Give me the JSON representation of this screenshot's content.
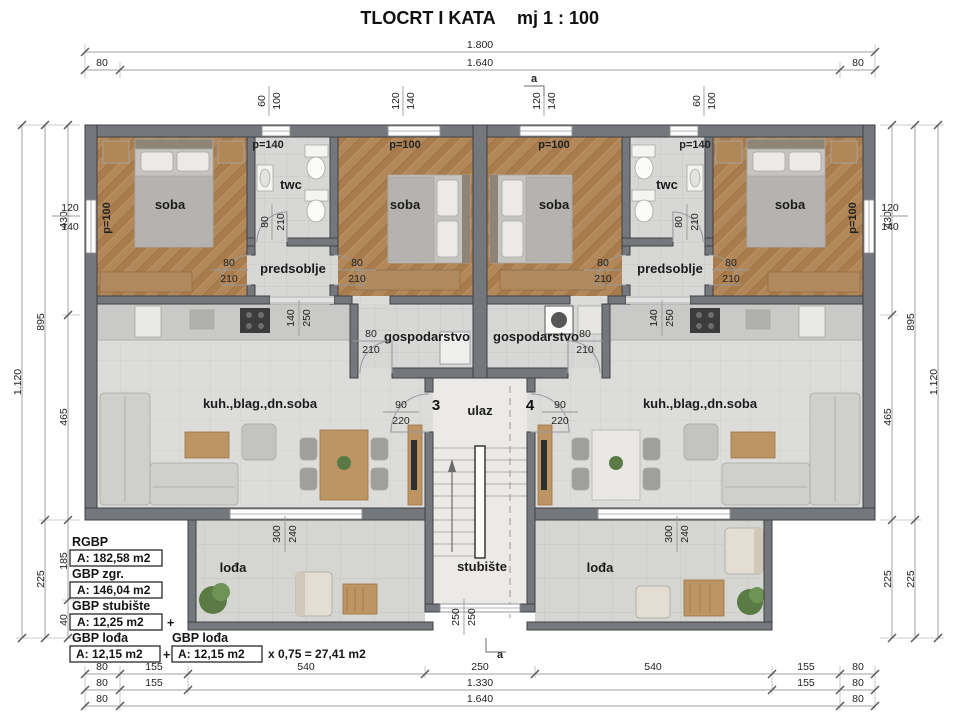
{
  "title": {
    "main": "TLOCRT I KATA",
    "scale": "mj 1 : 100"
  },
  "section_marker": "a",
  "dims": {
    "top": {
      "total": "1.800",
      "parts": [
        "80",
        "1.640",
        "80"
      ],
      "openings": [
        [
          "60",
          "100"
        ],
        [
          "120",
          "140"
        ],
        [
          "120",
          "140"
        ],
        [
          "60",
          "100"
        ]
      ]
    },
    "left": {
      "total": "1.120",
      "mid": [
        "895",
        "225"
      ],
      "inner": [
        "430",
        "465",
        "185",
        "40"
      ],
      "window": [
        "120",
        "140"
      ]
    },
    "right": {
      "total": "1.120",
      "mid": [
        "895",
        "225"
      ],
      "inner": [
        "430",
        "465",
        "225"
      ],
      "window": [
        "120",
        "140"
      ]
    },
    "bottom": {
      "row1": [
        "80",
        "155",
        "540",
        "250",
        "540",
        "155",
        "80"
      ],
      "row2": [
        "80",
        "155",
        "1.330",
        "155",
        "80"
      ],
      "row3": [
        "80",
        "1.640",
        "80"
      ]
    },
    "stair_window": [
      "250",
      "250"
    ],
    "loggia_opening": [
      "300",
      "240"
    ],
    "pred_opening": [
      "140",
      "250"
    ]
  },
  "rooms": {
    "bedroom": "soba",
    "toilet": "twc",
    "hall": "predsoblje",
    "utility": "gospodarstvo",
    "living": "kuh.,blag.,dn.soba",
    "entrance": "ulaz",
    "staircase": "stubište",
    "loggia": "lođa",
    "apt_left": "3",
    "apt_right": "4",
    "parapet100": "p=100",
    "parapet140": "p=140"
  },
  "doors": {
    "d80": "80",
    "d210": "210",
    "d90": "90",
    "d220": "220"
  },
  "areas": {
    "rgbp_label": "RGBP",
    "rgbp_value": "A: 182,58 m2",
    "gbp_zgr_label": "GBP zgr.",
    "gbp_zgr_value": "A: 146,04 m2",
    "gbp_stub_label": "GBP stubište",
    "gbp_stub_value": "A: 12,25 m2",
    "gbp_loda_label": "GBP lođa",
    "gbp_loda_value": "A: 12,15 m2",
    "gbp_loda2_label": "GBP lođa",
    "gbp_loda2_value": "A: 12,15 m2",
    "plus": "+",
    "formula": "x 0,75 = 27,41 m2"
  }
}
